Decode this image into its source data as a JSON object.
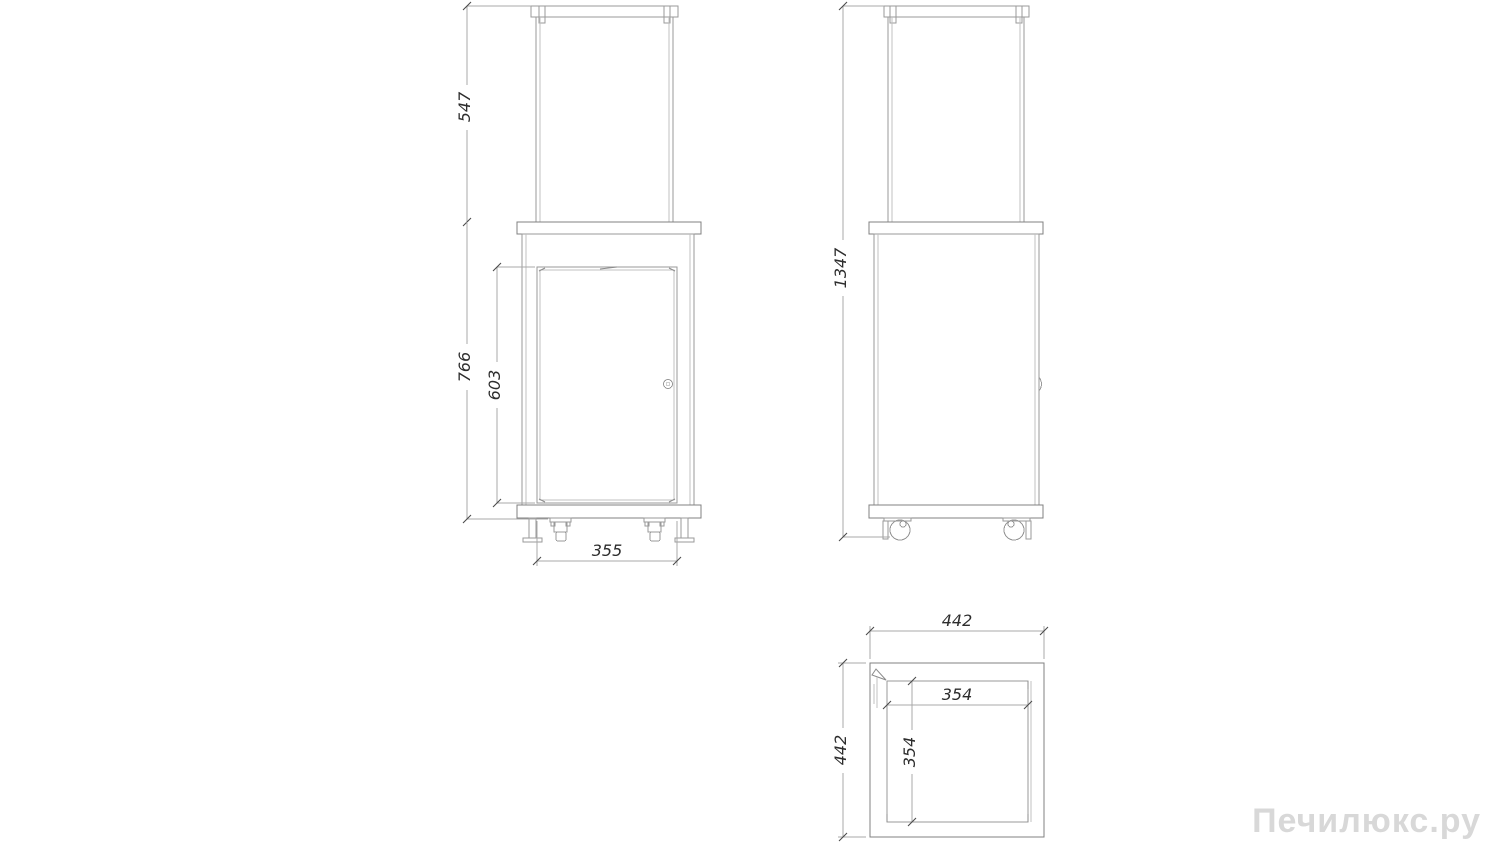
{
  "drawing": {
    "type": "technical-dimension-drawing",
    "watermark": "Печилюкс.ру",
    "views": {
      "front": {
        "dim_glass_section_height": "547",
        "dim_body_height": "766",
        "dim_door_height": "603",
        "dim_glass_width": "355"
      },
      "side": {
        "dim_overall_height": "1347"
      },
      "top": {
        "dim_outer_width": "442",
        "dim_outer_depth": "442",
        "dim_inner_width": "354",
        "dim_inner_depth": "354"
      }
    },
    "colors": {
      "object_line": "#9a9a9a",
      "dark_line": "#808080",
      "dimension_line": "#a8a8a8",
      "dimension_text": "#2d2d2d",
      "watermark_text": "#d8d8d8",
      "background": "#ffffff"
    }
  }
}
